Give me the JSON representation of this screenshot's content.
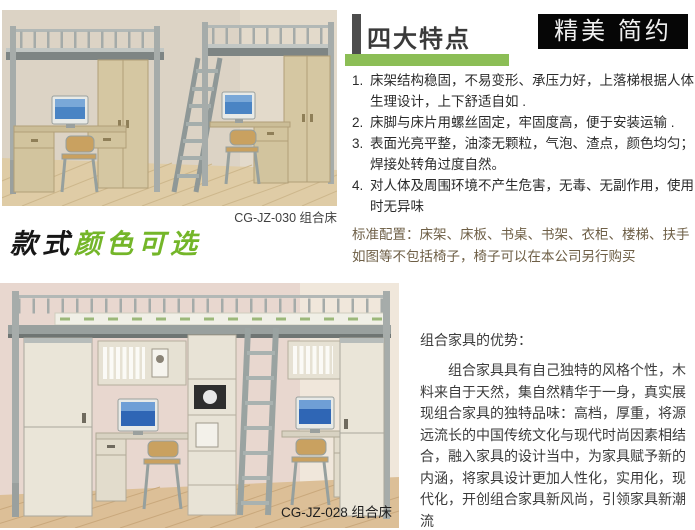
{
  "products": {
    "top": {
      "caption": "CG-JZ-030 组合床"
    },
    "bottom": {
      "caption": "CG-JZ-028 组合床"
    }
  },
  "style_note": {
    "black": "款式",
    "green": "颜色可选"
  },
  "features": {
    "title": "四大特点",
    "badge": "精美 简约",
    "items": [
      "床架结构稳固，不易变形、承压力好，上落梯根据人体生理设计，上下舒适自如 .",
      "床脚与床片用螺丝固定，牢固度高，便于安装运输 .",
      "表面光亮平整，油漆无颗粒，气泡、渣点，颜色均匀；焊接处转角过度自然。",
      "对人体及周围环境不产生危害，无毒、无副作用，使用时无异味"
    ],
    "standard_config": "标准配置：床架、床板、书桌、书架、衣柜、楼梯、扶手如图等不包括椅子，椅子可以在本公司另行购买"
  },
  "advantages": {
    "title": "组合家具的优势：",
    "body": "组合家具具有自己独特的风格个性，木料来自于天然，集自然精华于一身，真实展现组合家具的独特品味：高档，厚重，将源远流长的中国传统文化与现代时尚因素相结合，融入家具的设计当中，为家具赋予新的内涵，将家具设计更加人性化，实用化，现代化，开创组合家具新风尚，引领家具新潮流"
  },
  "colors": {
    "accent_green": "#8cbe56",
    "handwriting_green": "#74b629",
    "badge_bg": "#060606",
    "config_text": "#6e5f46"
  }
}
